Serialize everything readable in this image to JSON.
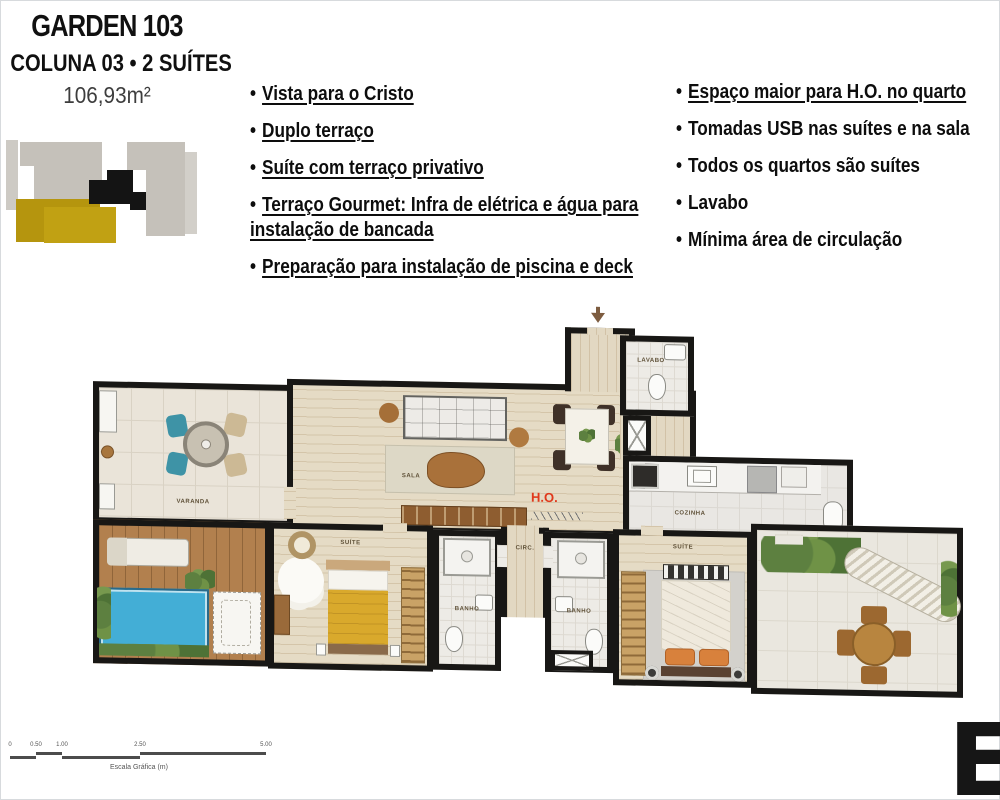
{
  "header": {
    "title": "GARDEN 103",
    "subtitle": "COLUNA 03 • 2 SUÍTES",
    "area": "106,93m²"
  },
  "features_left": [
    {
      "text": "Vista para o Cristo",
      "underline": true
    },
    {
      "text": "Duplo terraço",
      "underline": true
    },
    {
      "text": "Suíte com terraço privativo",
      "underline": true
    },
    {
      "text": "Terraço Gourmet: Infra de elétrica e água para instalação de bancada",
      "underline": true
    },
    {
      "text": "Preparação para instalação de piscina e deck",
      "underline": true
    }
  ],
  "features_right": [
    {
      "text": "Espaço maior para H.O. no quarto",
      "underline": true
    },
    {
      "text": "Tomadas USB nas suítes e na sala",
      "underline": false
    },
    {
      "text": "Todos os quartos são suítes",
      "underline": false
    },
    {
      "text": "Lavabo",
      "underline": false
    },
    {
      "text": "Mínima área de circulação",
      "underline": false
    }
  ],
  "floorplan": {
    "rooms": {
      "varanda": "VARANDA",
      "sala": "SALA",
      "ho": "H.O.",
      "lavabo": "LAVABO",
      "cozinha": "COZINHA",
      "suite1": "SUÍTE",
      "banho1": "BANHO",
      "circ": "CIRC.",
      "banho2": "BANHO",
      "suite2": "SUÍTE"
    }
  },
  "keyplan_blocks": [
    {
      "x": 2,
      "y": 8,
      "w": 12,
      "h": 70,
      "c": "#cdcac4"
    },
    {
      "x": 16,
      "y": 10,
      "w": 82,
      "h": 24,
      "c": "#c5c1ba"
    },
    {
      "x": 30,
      "y": 32,
      "w": 68,
      "h": 40,
      "c": "#c5c1ba"
    },
    {
      "x": 123,
      "y": 10,
      "w": 58,
      "h": 28,
      "c": "#c5c1ba"
    },
    {
      "x": 142,
      "y": 36,
      "w": 39,
      "h": 68,
      "c": "#c5c1ba"
    },
    {
      "x": 181,
      "y": 20,
      "w": 12,
      "h": 82,
      "c": "#d2cfc9"
    },
    {
      "x": 12,
      "y": 67,
      "w": 84,
      "h": 13,
      "c": "#b5950e"
    },
    {
      "x": 12,
      "y": 78,
      "w": 32,
      "h": 32,
      "c": "#b5950e"
    },
    {
      "x": 40,
      "y": 75,
      "w": 72,
      "h": 36,
      "c": "#c1a113"
    },
    {
      "x": 103,
      "y": 38,
      "w": 26,
      "h": 14,
      "c": "#141414"
    },
    {
      "x": 85,
      "y": 48,
      "w": 44,
      "h": 24,
      "c": "#141414"
    },
    {
      "x": 126,
      "y": 60,
      "w": 16,
      "h": 18,
      "c": "#141414"
    }
  ],
  "scale_bar": {
    "caption": "Escala Gráfica (m)",
    "ticks": [
      {
        "label": "0",
        "x": 2
      },
      {
        "label": "0.50",
        "x": 28
      },
      {
        "label": "1.00",
        "x": 54
      },
      {
        "label": "2.50",
        "x": 132
      },
      {
        "label": "5.00",
        "x": 258
      }
    ],
    "segments": [
      {
        "x": 2,
        "w": 26,
        "lvl": 1
      },
      {
        "x": 28,
        "w": 26,
        "lvl": 0
      },
      {
        "x": 54,
        "w": 78,
        "lvl": 1
      },
      {
        "x": 132,
        "w": 126,
        "lvl": 0
      }
    ]
  },
  "logo_letter": "E",
  "colors": {
    "wall": "#181715",
    "accent_red": "#e0391c",
    "pool": "#43aed6",
    "keyplan_yellow": "#c1a113"
  }
}
